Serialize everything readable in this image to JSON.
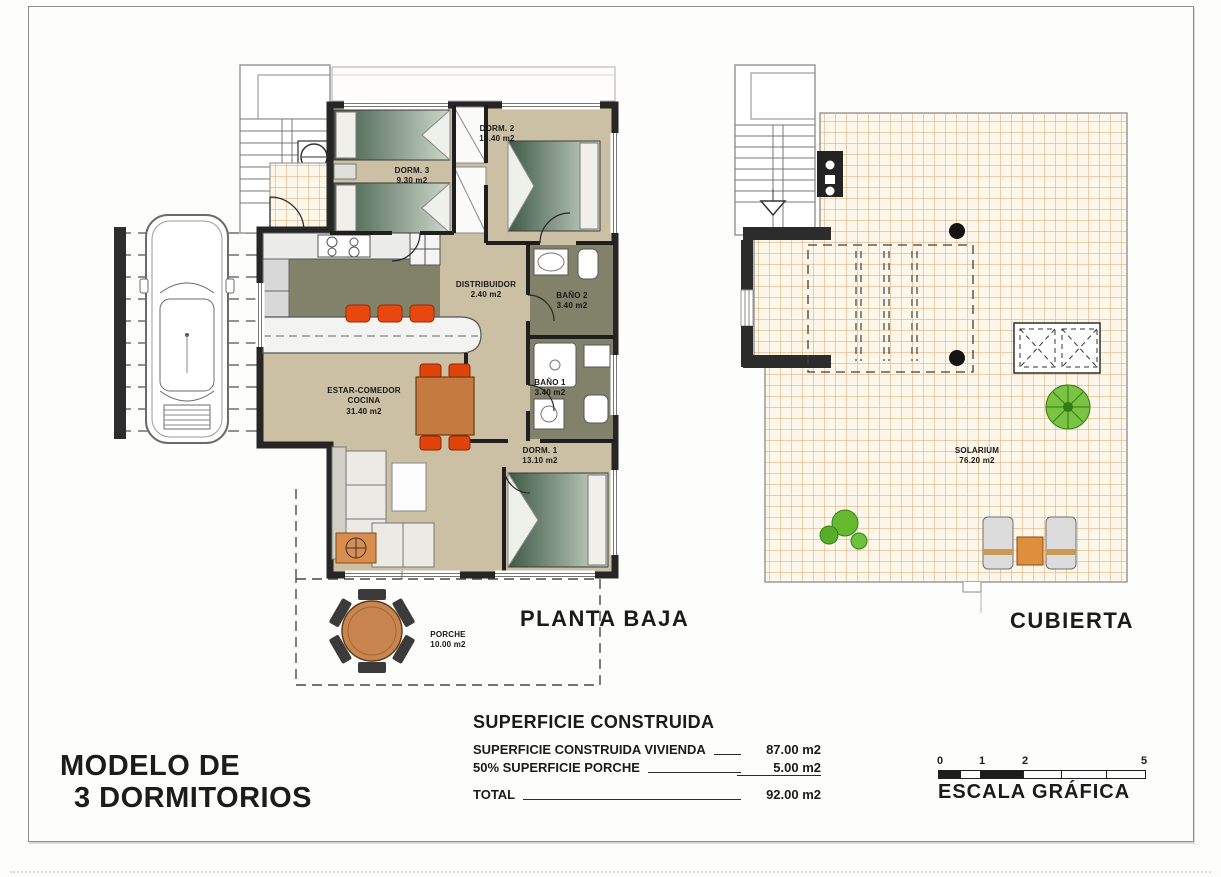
{
  "sheet": {
    "model_title_line1": "MODELO DE",
    "model_title_line2": "3 DORMITORIOS"
  },
  "plans": {
    "planta_baja": {
      "title": "PLANTA BAJA"
    },
    "cubierta": {
      "title": "CUBIERTA"
    }
  },
  "rooms": {
    "dorm3": {
      "name": "DORM. 3",
      "area": "9.30 m2"
    },
    "dorm2": {
      "name": "DORM. 2",
      "area": "10.40 m2"
    },
    "distribuidor": {
      "name": "DISTRIBUIDOR",
      "area": "2.40 m2"
    },
    "bano2": {
      "name": "BAÑO 2",
      "area": "3.40 m2"
    },
    "bano1": {
      "name": "BAÑO 1",
      "area": "3.40 m2"
    },
    "estar": {
      "name_line1": "ESTAR-COMEDOR",
      "name_line2": "COCINA",
      "area": "31.40 m2"
    },
    "dorm1": {
      "name": "DORM. 1",
      "area": "13.10 m2"
    },
    "porche": {
      "name": "PORCHE",
      "area": "10.00 m2"
    },
    "solarium": {
      "name": "SOLARIUM",
      "area": "76.20 m2"
    }
  },
  "surface_table": {
    "title": "SUPERFICIE CONSTRUIDA",
    "rows": [
      {
        "label": "SUPERFICIE CONSTRUIDA VIVIENDA",
        "value": "87.00 m2"
      },
      {
        "label": "50% SUPERFICIE PORCHE",
        "value": "5.00 m2"
      }
    ],
    "total_label": "TOTAL",
    "total_value": "92.00 m2"
  },
  "scale": {
    "caption": "ESCALA GRÁFICA",
    "ticks": [
      "0",
      "1",
      "2",
      "5"
    ]
  },
  "colors": {
    "floor_beige": "#cbbfa4",
    "wet_zone_olive": "#82826a",
    "tile_line_orange": "#d9a469",
    "bed_green": "#3f5a47",
    "accent_orange": "#e8480e",
    "wood_orange": "#c8854f",
    "wall_black": "#262626",
    "plant_green": "#5cb531"
  }
}
